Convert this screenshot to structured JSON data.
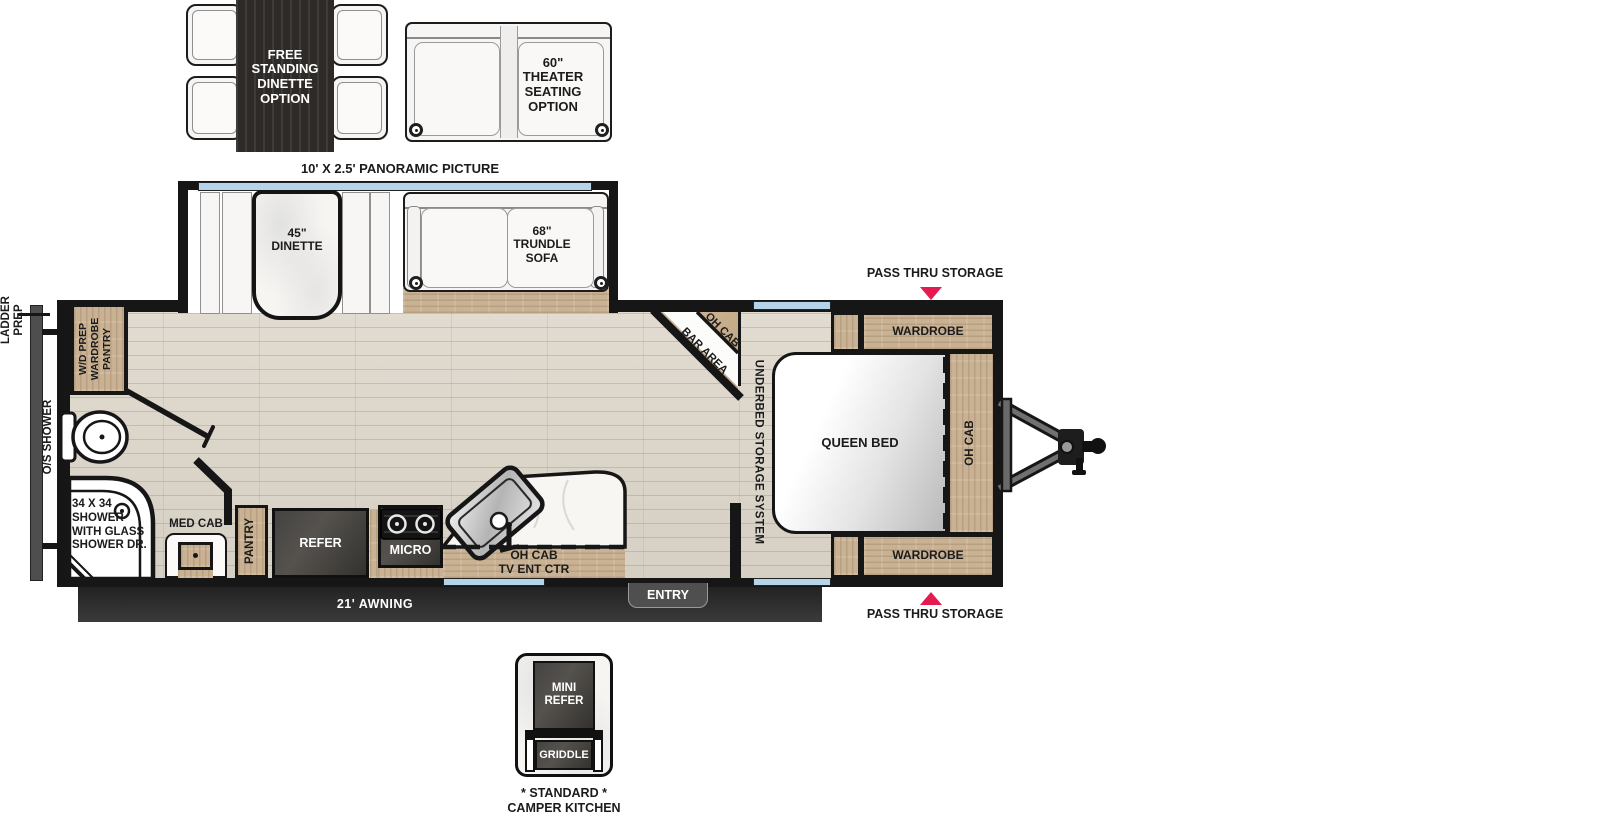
{
  "options": {
    "free_standing_dinette": "FREE STANDING DINETTE OPTION",
    "theater_seating": "60\" THEATER SEATING OPTION",
    "panoramic_picture": "10' X 2.5' PANORAMIC PICTURE"
  },
  "slideout": {
    "dinette": "45\" DINETTE",
    "trundle_sofa": "68\" TRUNDLE SOFA"
  },
  "rear": {
    "ladder_prep": "LADDER PREP",
    "os_shower": "O/S SHOWER"
  },
  "bathroom": {
    "wd_prep": "W/D PREP WARDROBE PANTRY",
    "shower": "34 X 34 SHOWER WITH GLASS SHOWER DR.",
    "med_cab": "MED CAB"
  },
  "kitchen": {
    "pantry": "PANTRY",
    "refer": "REFER",
    "micro": "MICRO",
    "oh_cab_tv_lines": [
      "OH CAB",
      "TV ENT CTR"
    ]
  },
  "living": {
    "oh_cab": "OH CAB",
    "bar_area": "BAR AREA"
  },
  "bedroom": {
    "underbed_storage": "UNDERBED STORAGE SYSTEM",
    "queen_bed": "QUEEN BED",
    "wardrobe_rear": "WARDROBE",
    "wardrobe_front": "WARDROBE",
    "oh_cab": "OH CAB",
    "pass_thru_top": "PASS THRU STORAGE",
    "pass_thru_bottom": "PASS THRU STORAGE"
  },
  "exterior": {
    "awning": "21' AWNING",
    "entry": "ENTRY"
  },
  "camper_kitchen": {
    "mini_refer": "MINI REFER",
    "griddle": "GRIDDLE",
    "caption_lines": [
      "* STANDARD *",
      "CAMPER KITCHEN"
    ]
  },
  "colors": {
    "accent_red": "#e51a4f",
    "window_blue": "#b5d4e9",
    "wood_tan": "#c9b293",
    "floor_wood": "#ddd6ca",
    "appliance_dark": "#413f3c",
    "wall_black": "#161616"
  }
}
